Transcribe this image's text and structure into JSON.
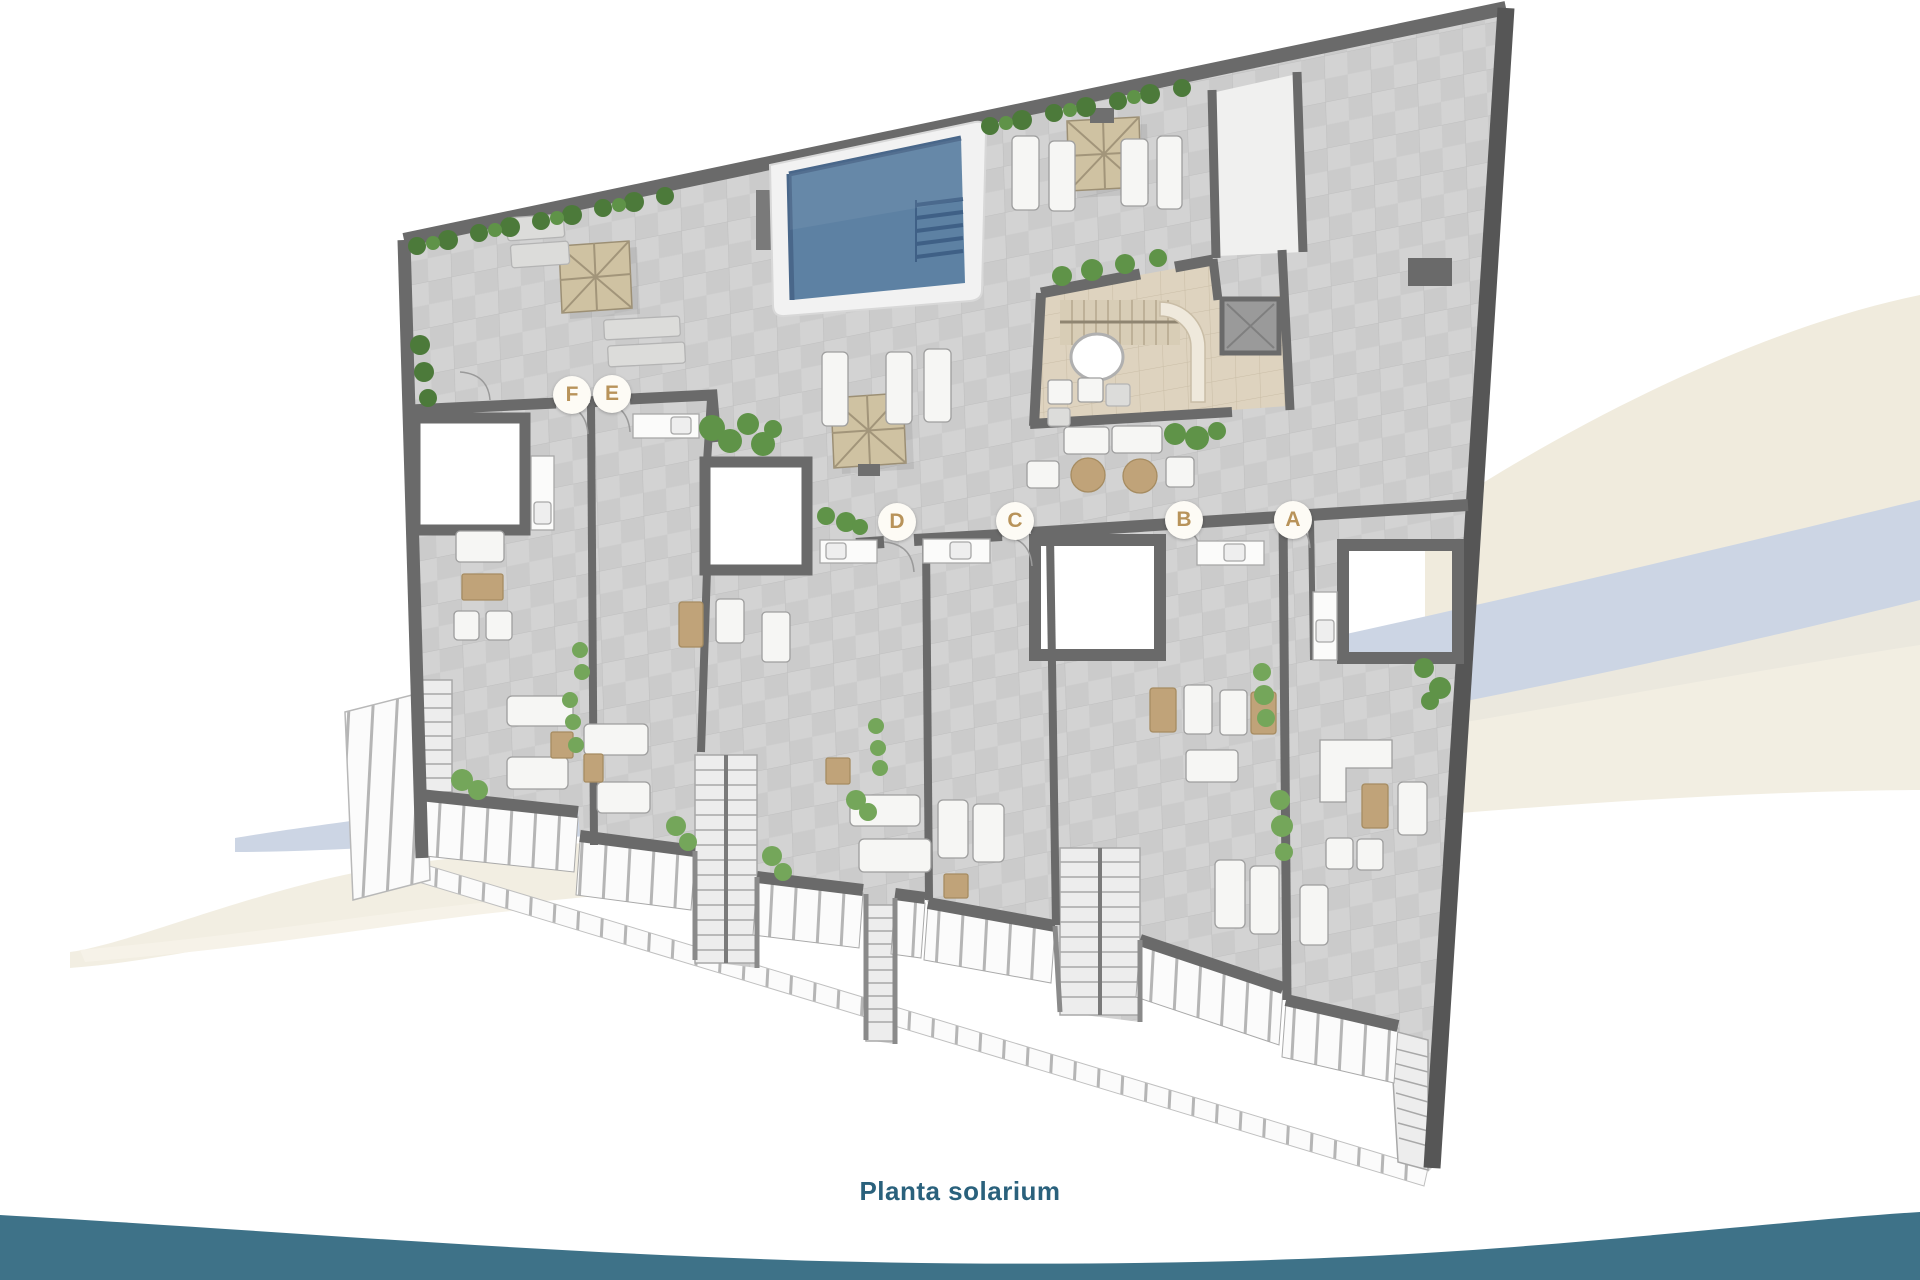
{
  "caption": {
    "text": "Planta solarium"
  },
  "plan": {
    "name": "solarium-floorplan",
    "unit_badges": [
      {
        "label": "F",
        "x": 572,
        "y": 395
      },
      {
        "label": "E",
        "x": 612,
        "y": 394
      },
      {
        "label": "D",
        "x": 897,
        "y": 522
      },
      {
        "label": "C",
        "x": 1015,
        "y": 521
      },
      {
        "label": "B",
        "x": 1184,
        "y": 520
      },
      {
        "label": "A",
        "x": 1293,
        "y": 520
      }
    ]
  },
  "colors": {
    "badge_bg": "#fdfbf5",
    "badge_text": "#b8935a",
    "caption": "#2a617c",
    "footer_teal": "#3e7288",
    "swoosh_cream": "#f0ebdd",
    "swoosh_cream_light": "#f6f2e8",
    "swoosh_blue": "#ccd5e4",
    "wall": "#6a6a6a",
    "wall_dark": "#565656",
    "tile_a": "#cbcbcb",
    "tile_b": "#d3d3d3",
    "tile_line": "#bfbfbf",
    "pool_deck": "#f2f2f2",
    "pool_water": "#5d81a3",
    "pool_water_dark": "#49678a",
    "parasol": "#cfc2a2",
    "parasol_rib": "#a2957a",
    "core_floor": "#ded3bf",
    "core_line": "#c9bda6",
    "plant_dark": "#4c7a3a",
    "plant_mid": "#5f9348",
    "plant_light": "#74a65a",
    "furniture_white": "#f6f6f4",
    "furniture_stroke": "#9e9e9e",
    "tan": "#c0a379",
    "tan_stroke": "#a68c61",
    "railing": "#fbfbfb",
    "railing_post": "#b5b5b5",
    "stair": "#ededed",
    "stair_tread": "#a8a8a8",
    "elevator": "#9a9a9a"
  }
}
